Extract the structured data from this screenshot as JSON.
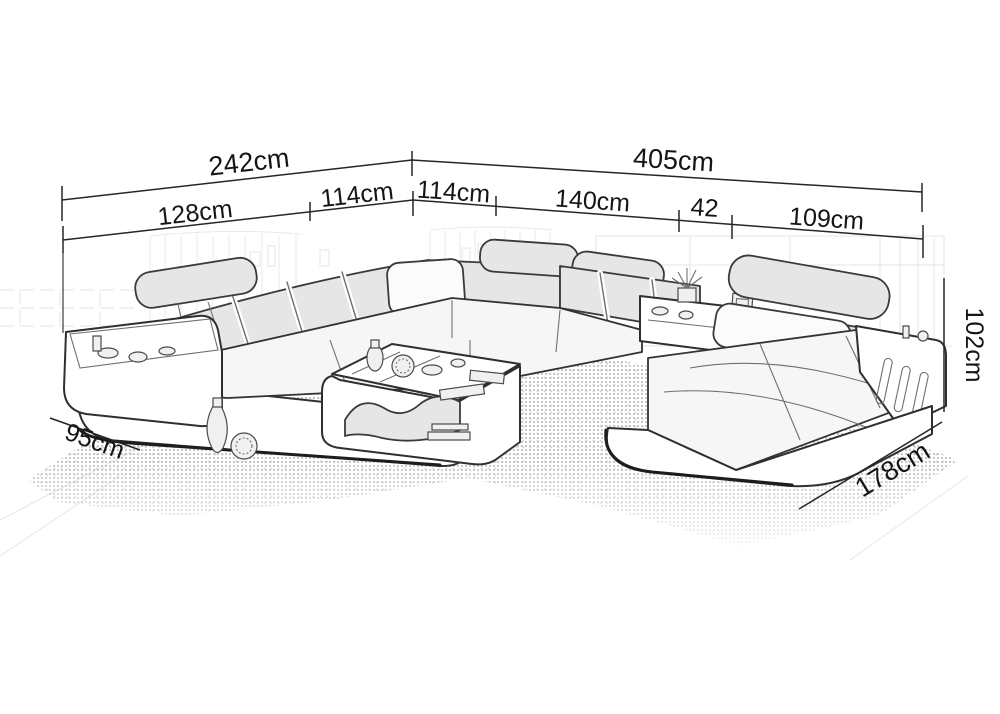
{
  "diagram": {
    "subject": "u-shaped-sectional-sofa-dimension-drawing",
    "dims": {
      "total_left": "242cm",
      "total_right": "405cm",
      "seg_left_a": "128cm",
      "seg_left_b": "114cm",
      "seg_right_a": "114cm",
      "seg_right_b": "140cm",
      "seg_right_c": "42",
      "seg_right_d": "109cm",
      "height_right": "102cm",
      "depth_left": "95cm",
      "depth_right": "178cm"
    },
    "colors": {
      "line": "#262626",
      "text": "#151515",
      "sketch": "#2f2f2f",
      "background": "#ffffff"
    }
  }
}
